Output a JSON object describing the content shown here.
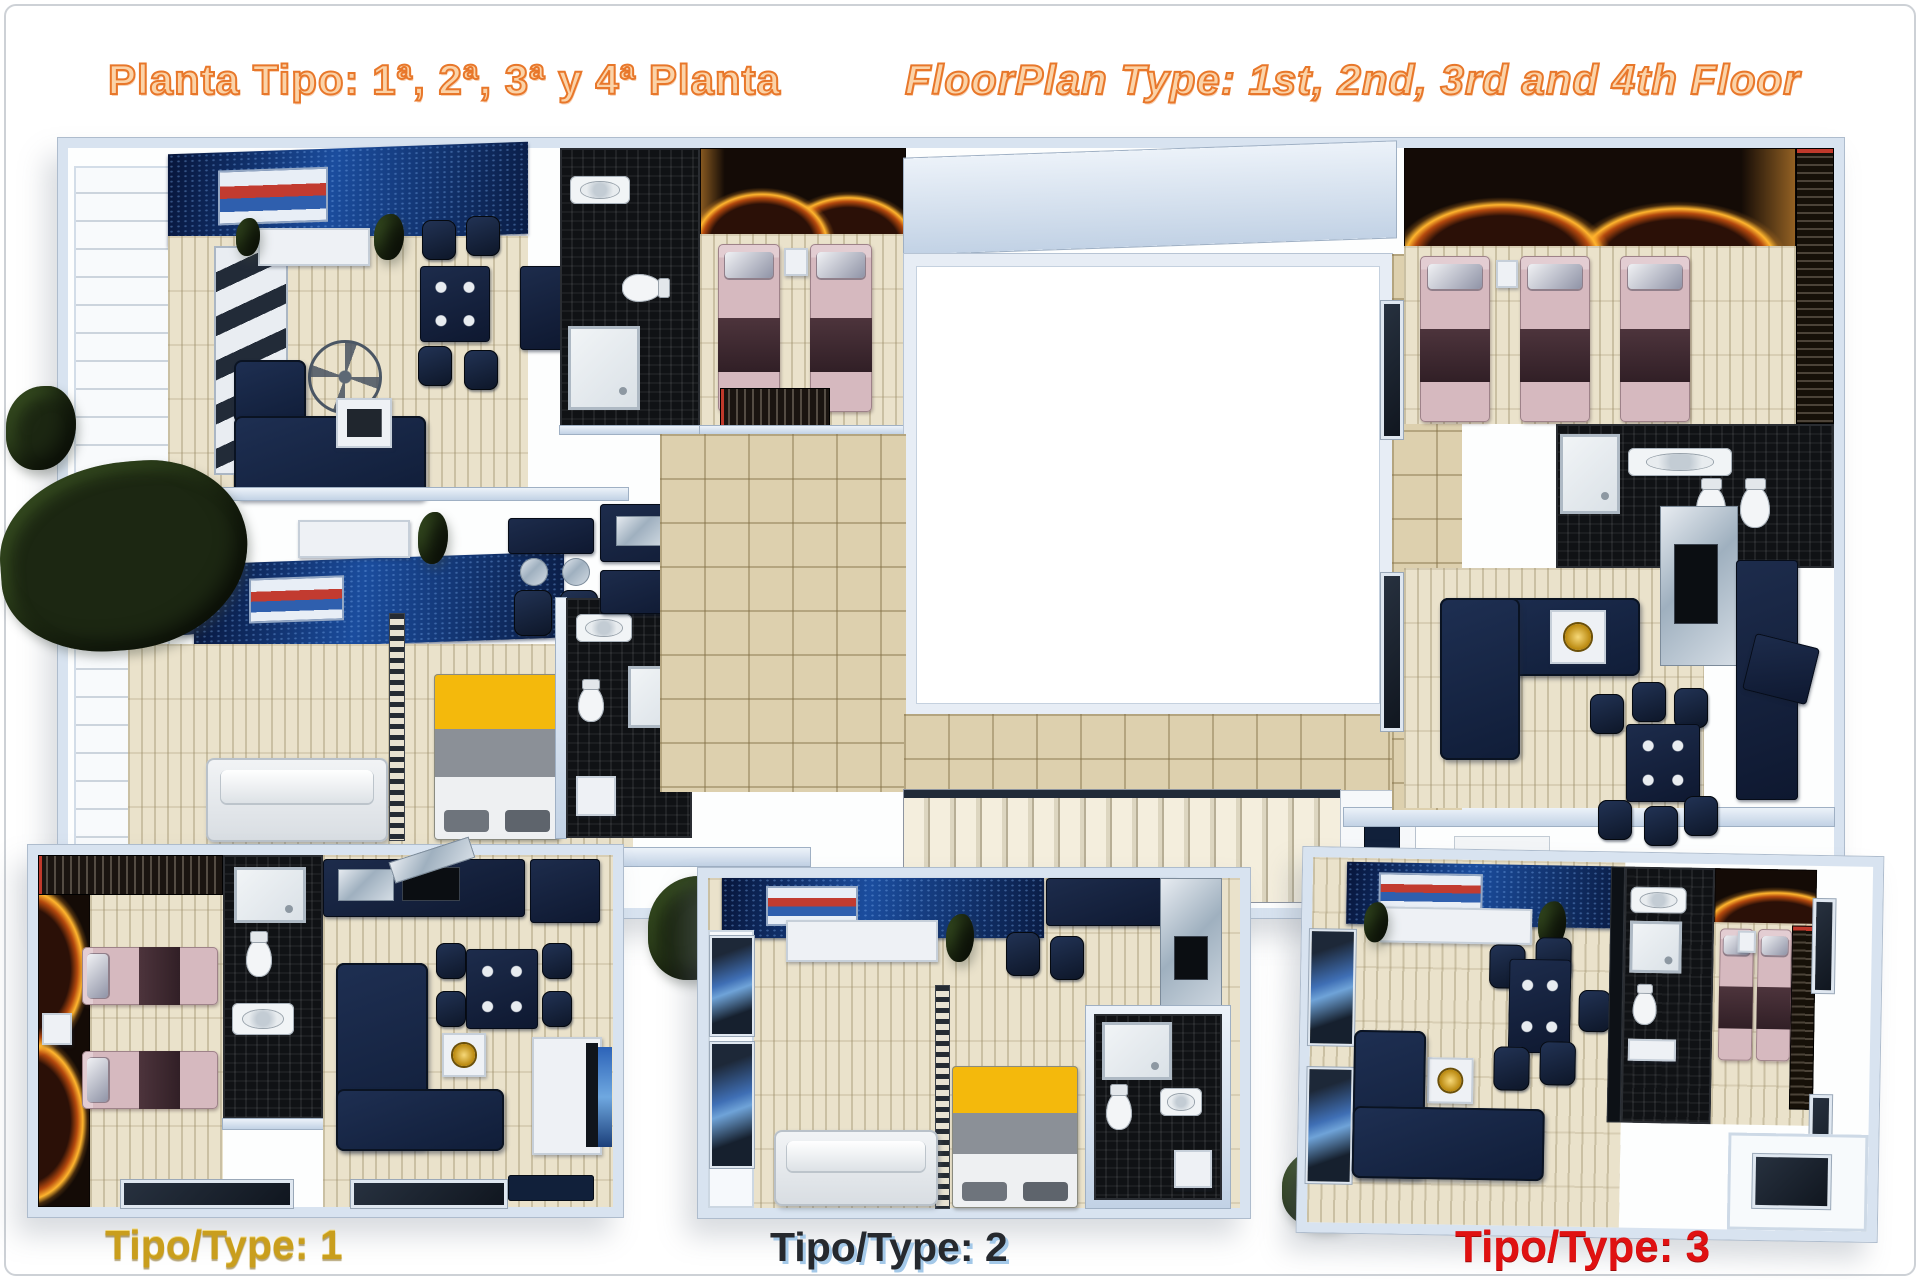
{
  "header": {
    "title_es": "Planta Tipo: 1ª, 2ª, 3ª y 4ª Planta",
    "title_en": "FloorPlan Type: 1st, 2nd, 3rd and 4th Floor",
    "title_color": "#ED7D31"
  },
  "labels": {
    "type1": "Tipo/Type: 1",
    "type2": "Tipo/Type: 2",
    "type3": "Tipo/Type: 3",
    "type1_color": "#C99E1D",
    "type2_color": "#26292E",
    "type2_shadow": "#A3C8E8",
    "type3_color": "#E01111"
  },
  "palette": {
    "wall_light_blue": "#D8E3F0",
    "floor_beige": "#EAE2CB",
    "hall_tile": "#DDD0AE",
    "accent_navy_wall": "#1B4D9E",
    "sofa_navy": "#16233C",
    "bed_pink": "#D6B9BF",
    "bed_blanket_brown": "#4D343C",
    "bed_yellow": "#F4B90C",
    "fire_glow_orange": "#FFB52E",
    "bathroom_black_tile": "#101215",
    "fixture_white": "#EEF1F5",
    "courtyard_white": "#FFFFFF"
  }
}
